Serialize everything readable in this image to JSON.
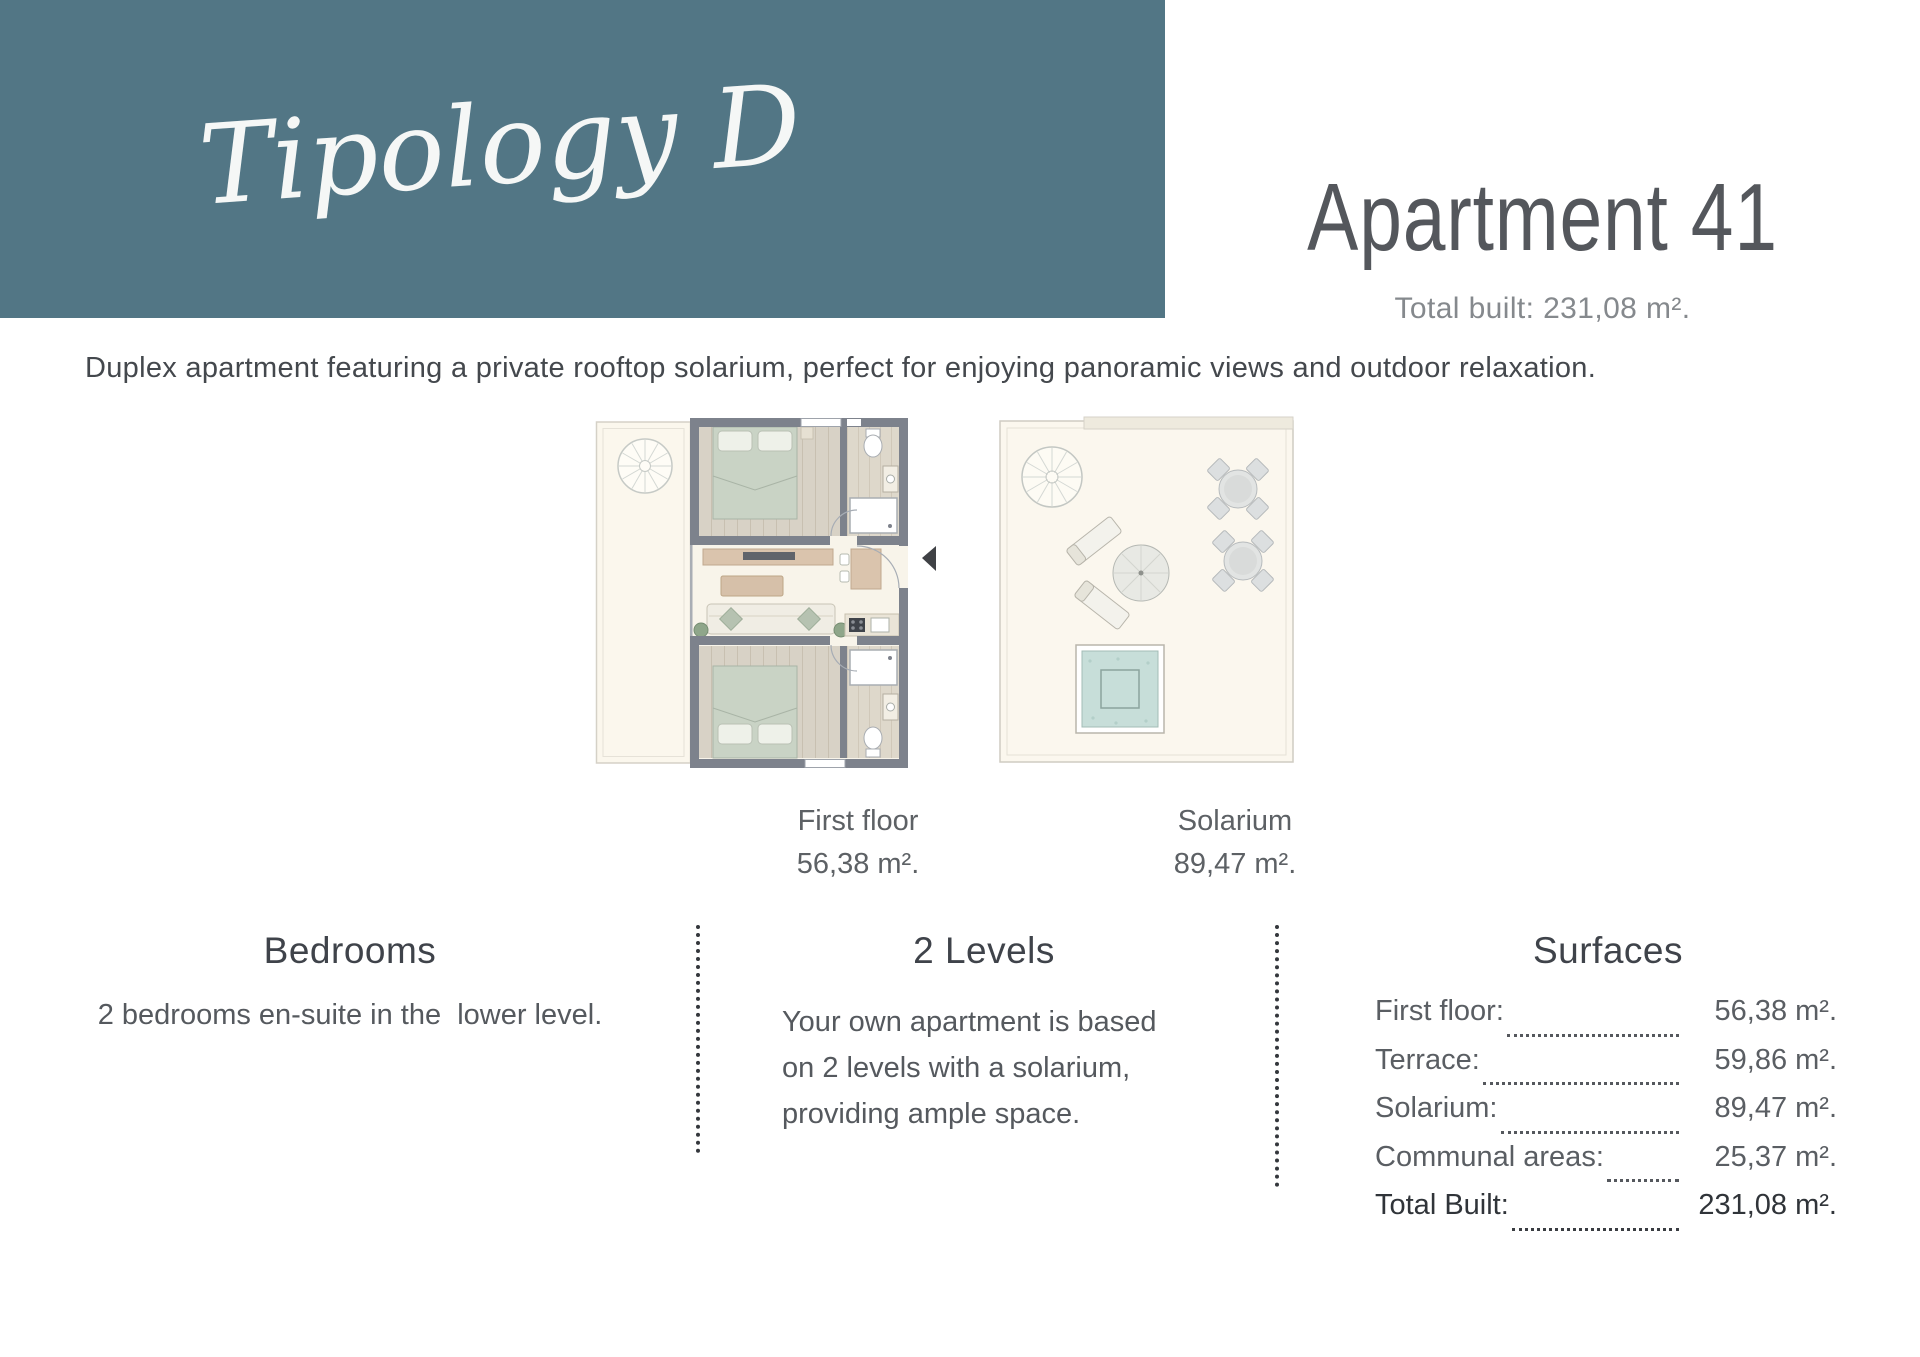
{
  "theme": {
    "accent_teal": "#527685"
  },
  "header": {
    "typology_label": "Tipology D",
    "apartment_title": "Apartment 41",
    "total_built": "Total built: 231,08 m²."
  },
  "description": "Duplex apartment featuring a private rooftop solarium, perfect for enjoying panoramic views and outdoor relaxation.",
  "plans": {
    "first_floor": {
      "label": "First floor",
      "area": "56,38 m²."
    },
    "solarium": {
      "label": "Solarium",
      "area": "89,47 m²."
    }
  },
  "sections": {
    "bedrooms": {
      "heading": "Bedrooms",
      "body": "2 bedrooms en-suite in the  lower level."
    },
    "levels": {
      "heading": "2 Levels",
      "body": "Your own apartment is based on 2 levels with a solarium, providing ample space."
    },
    "surfaces": {
      "heading": "Surfaces",
      "rows": [
        {
          "label": "First floor:",
          "value": "56,38 m²."
        },
        {
          "label": "Terrace:",
          "value": "59,86 m²."
        },
        {
          "label": "Solarium:",
          "value": "89,47 m²."
        },
        {
          "label": "Communal areas:",
          "value": "25,37 m²."
        },
        {
          "label": "Total Built:",
          "value": "231,08 m²."
        }
      ]
    }
  }
}
